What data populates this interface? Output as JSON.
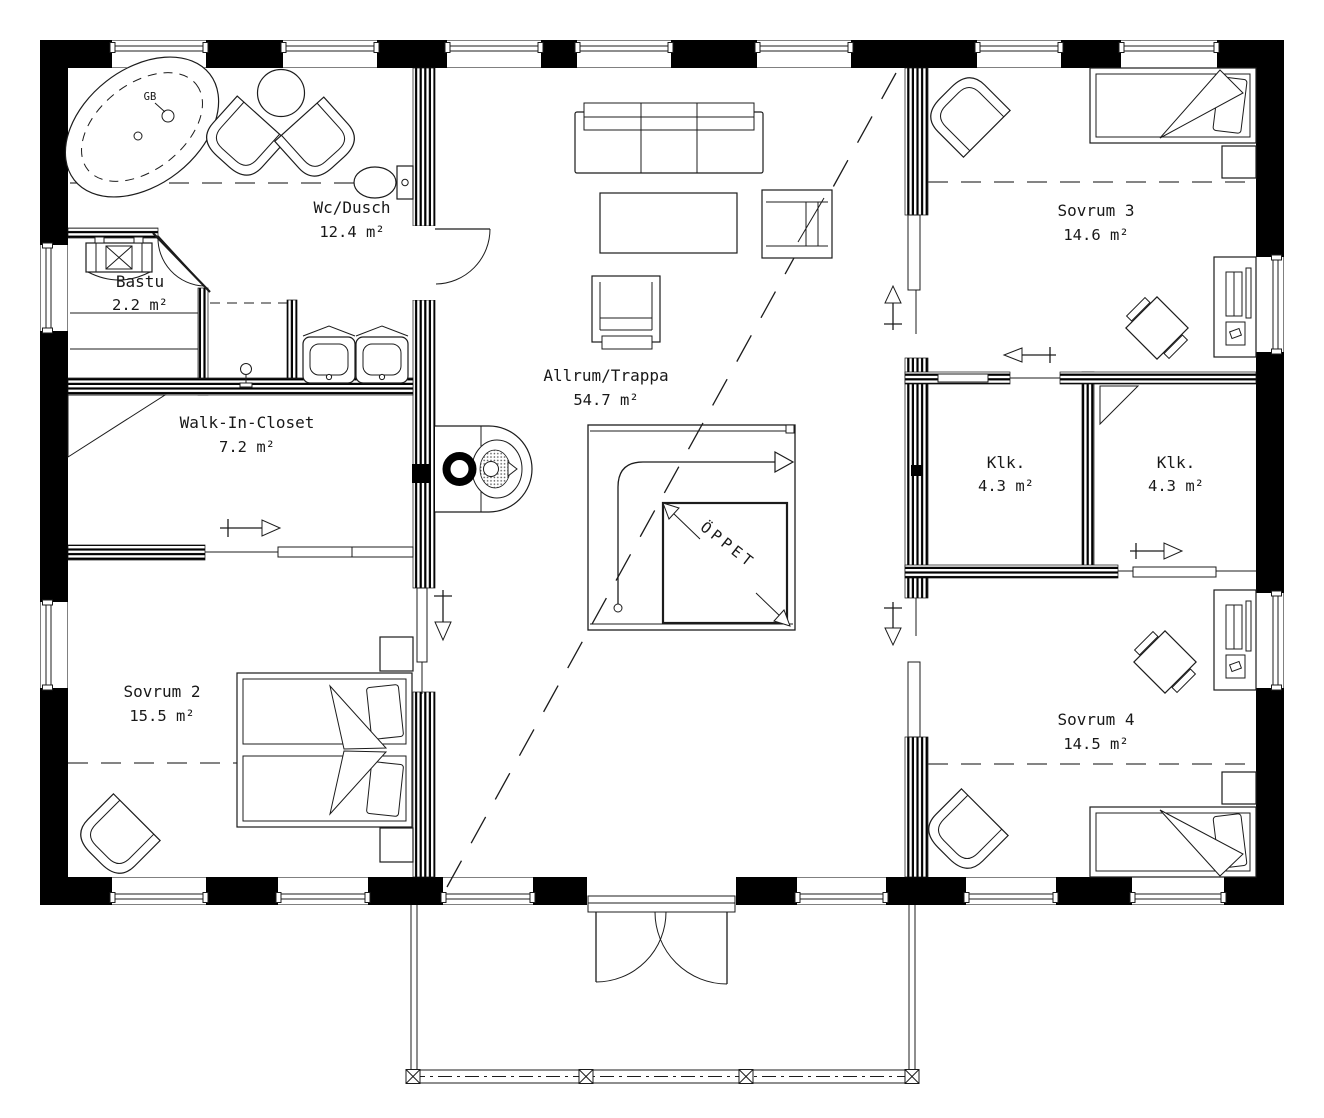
{
  "plan": {
    "rooms": [
      {
        "name": "Wc/Dusch",
        "area": "12.4 m²"
      },
      {
        "name": "Bastu",
        "area": "2.2 m²"
      },
      {
        "name": "Walk-In-Closet",
        "area": "7.2 m²"
      },
      {
        "name": "Sovrum 2",
        "area": "15.5 m²"
      },
      {
        "name": "Allrum/Trappa",
        "area": "54.7 m²"
      },
      {
        "name": "Sovrum 3",
        "area": "14.6 m²"
      },
      {
        "name": "Klk.",
        "area": "4.3 m²"
      },
      {
        "name": "Klk.",
        "area": "4.3 m²"
      },
      {
        "name": "Sovrum 4",
        "area": "14.5 m²"
      }
    ],
    "annotations": {
      "open_to_below": "ÖPPET",
      "floor_drain": "GB"
    },
    "colors": {
      "exterior_wall": "#000000",
      "line": "#1c1c1c",
      "background": "#ffffff"
    }
  }
}
